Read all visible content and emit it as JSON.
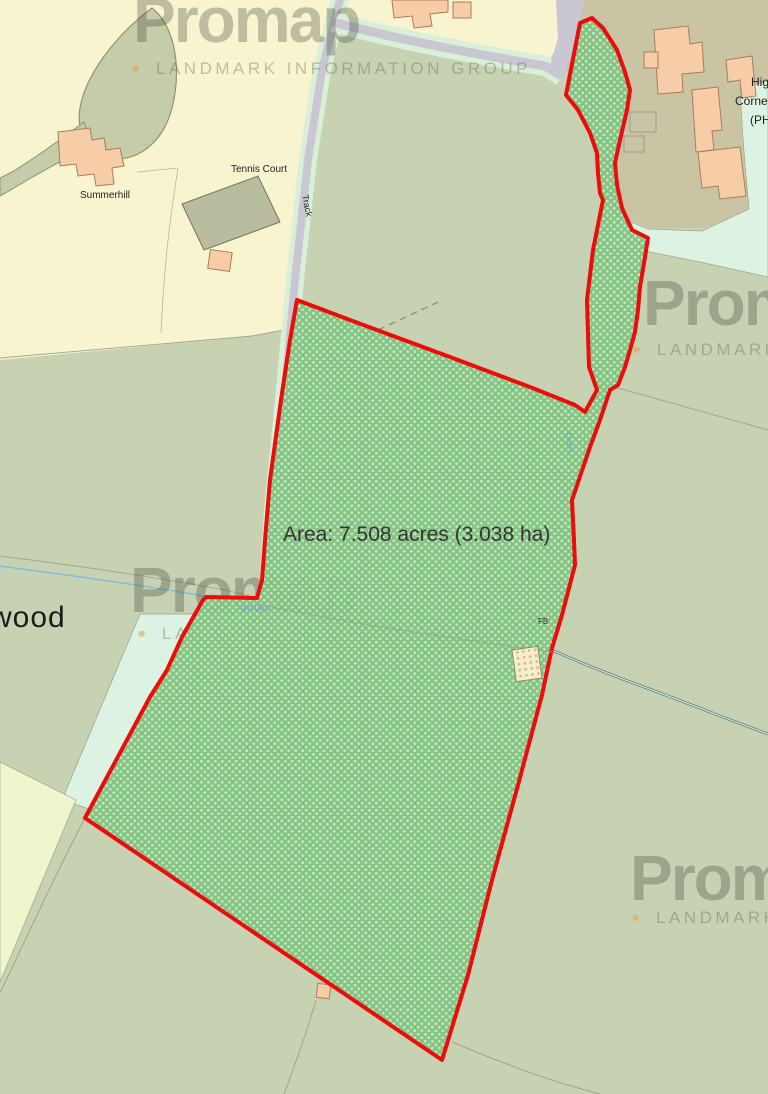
{
  "watermark": {
    "brand": "Promap",
    "bullet": "●",
    "tagline": "LANDMARK INFORMATION GROUP"
  },
  "parcel": {
    "area_label": "Area: 7.508 acres (3.038 ha)"
  },
  "labels": {
    "summerhill": "Summerhill",
    "tennis_court": "Tennis Court",
    "track": "Track",
    "wood": "wood",
    "place_line1": "Hig",
    "place_line2": "Corne",
    "place_line3": "(PH",
    "footbridge": "FB",
    "drain": "Drain",
    "issues": "Issues"
  },
  "colors": {
    "boundary_red": "#ee0b0b",
    "parcel_green": "#7fc280",
    "parcel_dot": "#bfe5b8",
    "field_sage": "#c7d2b3",
    "field_olive": "#c9c5a4",
    "garden_yellow": "#f8f4d0",
    "mint_green": "#d9efd8",
    "mint_pale": "#dcf3e3",
    "road_grey": "#c9c7d1",
    "building_peach": "#f6cda7",
    "building_outline": "#ab7c58",
    "water_blue": "#85bcd9",
    "pale_field": "#eff5cd"
  }
}
